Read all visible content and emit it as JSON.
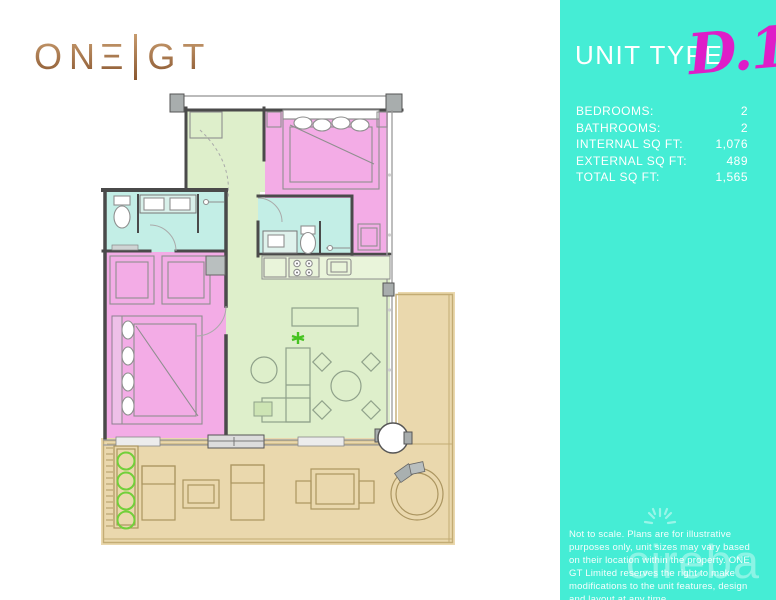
{
  "brand": {
    "full_name": "ONE|GT",
    "logo_left": "ON",
    "logo_e_glyph": "Ξ",
    "logo_right": "GT"
  },
  "sidebar": {
    "title": "UNIT TYPE",
    "unit_code": "D.1",
    "specs": [
      {
        "label": "BEDROOMS:",
        "value": "2"
      },
      {
        "label": "BATHROOMS:",
        "value": "2"
      },
      {
        "label": "INTERNAL SQ FT:",
        "value": "1,076"
      },
      {
        "label": "EXTERNAL SQ FT:",
        "value": "489"
      },
      {
        "label": "TOTAL SQ FT:",
        "value": "1,565"
      }
    ],
    "disclaimer": "Not to scale. Plans are for illustrative purposes only, unit sizes may vary based on their location within the property. ONE GT Limited reserves the right to make modifications to the unit features, design and layout at any time.",
    "watermark": "cireba"
  },
  "floorplan_legend": {
    "bedrooms_color_note": "pink",
    "bathrooms_color_note": "turquoise",
    "living_kitchen_entry_color_note": "green",
    "terrace_color_note": "tan"
  },
  "colors": {
    "teal": "#45EDD5",
    "magenta": "#DE1EC8",
    "copper_light": "#C79B6E",
    "copper_dark": "#8A5730",
    "room_pink": "#F3ACE6",
    "room_green": "#DEEFCB",
    "room_bath": "#C3EEE6",
    "terrace_tan": "#EAD8AD",
    "wall": "#4A4A4A",
    "white": "#FFFFFF"
  }
}
